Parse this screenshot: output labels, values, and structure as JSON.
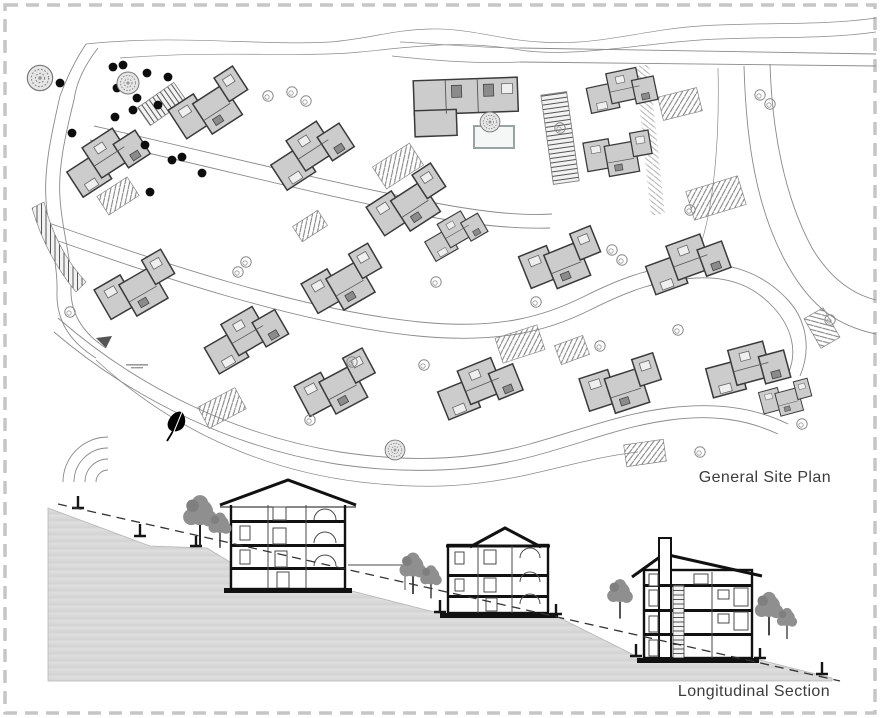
{
  "drawing": {
    "plan_label": "General Site Plan",
    "section_label": "Longitudinal Section"
  },
  "colors": {
    "background": "#ffffff",
    "border_dash": "#c6c6c6",
    "building_fill": "#cccccc",
    "building_stroke": "#3a3a3a",
    "emphasis_stroke": "#141414",
    "road_line": "#8a8a8a",
    "terrain_fill": "#d9d9d9",
    "tree_plan_dark": "#0d0d0d",
    "tree_plan_light": "#8a8a8a",
    "tree_section": "#8f8f8f",
    "section_ink": "#111111",
    "label_text": "#3c3c3c"
  }
}
